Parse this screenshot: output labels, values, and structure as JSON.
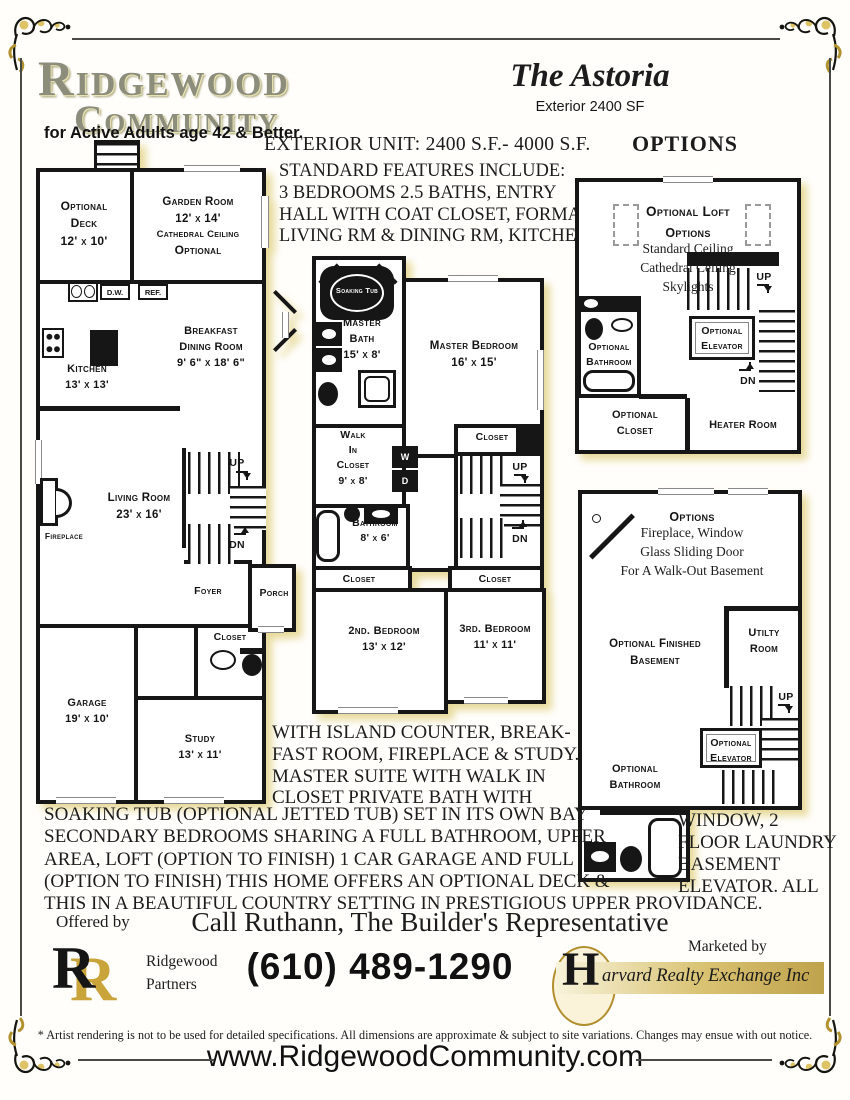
{
  "colors": {
    "gold": "#c9a43a",
    "plan_shadow": "#e7da9b",
    "wall": "#161616"
  },
  "header": {
    "logo_line1": "RIDGEWOOD",
    "logo_line2": "COMMUNITY",
    "tagline": "for Active Adults age 42 & Better.",
    "model_name": "The Astoria",
    "model_sub": "Exterior 2400 SF"
  },
  "headings": {
    "exterior_unit": "EXTERIOR UNIT: 2400 S.F.- 4000 S.F.",
    "options": "OPTIONS",
    "features": "STANDARD FEATURES INCLUDE:\n3 BEDROOMS 2.5 BATHS, ENTRY\nHALL WITH COAT CLOSET, FORMAL\nLIVING RM & DINING RM, KITCHEN"
  },
  "plan1": {
    "deck": "Optional\nDeck\n12' x 10'",
    "garden": "Garden Room\n12' x 14'",
    "garden_sub": "Cathedral Ceiling",
    "garden_opt": "Optional",
    "dw": "D.W.",
    "ref": "REF.",
    "kitchen": "Kitchen\n13' x 13'",
    "breakfast": "Breakfast\nDining Room\n9' 6\" x 18' 6\"",
    "living": "Living Room\n23' x 16'",
    "fireplace": "Fireplace",
    "up": "UP",
    "dn": "DN",
    "foyer": "Foyer",
    "porch": "Porch",
    "closet": "Closet",
    "garage": "Garage\n19' x 10'",
    "study": "Study\n13' x 11'"
  },
  "plan2": {
    "soaking_tub": "Soaking Tub",
    "master_bath": "Master\nBath\n15' x 8'",
    "master_bedroom": "Master Bedroom\n16' x 15'",
    "walk_in_closet": "Walk\nIn\nCloset\n9' x 8'",
    "washer": "W",
    "dryer": "D",
    "bathroom": "Bathroom\n8' x 6'",
    "closet_a": "Closet",
    "closet_b": "Closet",
    "closet_c": "Closet",
    "up": "UP",
    "dn": "DN",
    "bedroom2": "2nd. Bedroom\n13' x 12'",
    "bedroom3": "3rd. Bedroom\n11' x 11'"
  },
  "plan3": {
    "title": "Optional Loft",
    "options": "Options",
    "options_list": "Standard Ceiling\nCathedral Ceiling\nSkylights",
    "bathroom": "Optional\nBathroom",
    "elevator": "Optional\nElevator",
    "up": "UP",
    "dn": "DN",
    "closet": "Optional\nCloset",
    "heater": "Heater Room"
  },
  "plan4": {
    "options": "Options",
    "options_list": "Fireplace, Window\nGlass Sliding Door\nFor A Walk-Out Basement",
    "finished": "Optional Finished\nBasement",
    "utility": "Utilty\nRoom",
    "up": "UP",
    "elevator": "Optional\nElevator",
    "bathroom": "Optional\nBathroom"
  },
  "description": {
    "mid": "WITH ISLAND COUNTER, BREAK-\nFAST ROOM,  FIREPLACE & STUDY.\nMASTER SUITE WITH WALK IN\nCLOSET PRIVATE BATH WITH",
    "full": "SOAKING TUB (OPTIONAL JETTED TUB) SET IN ITS OWN BAY\nSECONDARY BEDROOMS SHARING A FULL BATHROOM, UPPER\nAREA, LOFT (OPTION TO FINISH)    1 CAR GARAGE   AND   FULL\n(OPTION TO FINISH) THIS HOME OFFERS AN OPTIONAL  DECK &\nTHIS IN A BEAUTIFUL COUNTRY SETTING IN PRESTIGIOUS UPPER PROVIDANCE.",
    "side": "WINDOW, 2\nFLOOR LAUNDRY\nBASEMENT\nELEVATOR.  ALL"
  },
  "footer": {
    "offered_by": "Offered by",
    "call_line": "Call Ruthann, The Builder's Representative",
    "partners_initial": "R",
    "partners_name": "Ridgewood\nPartners",
    "phone": "(610) 489-1290",
    "marketed_by": "Marketed by",
    "harvard_initial": "H",
    "harvard_name": "arvard Realty Exchange Inc",
    "disclaimer": "* Artist rendering is not to be used for detailed specifications. All dimensions are approximate & subject to site variations. Changes may ensue with out notice.",
    "website": "www.RidgewoodCommunity.com"
  }
}
